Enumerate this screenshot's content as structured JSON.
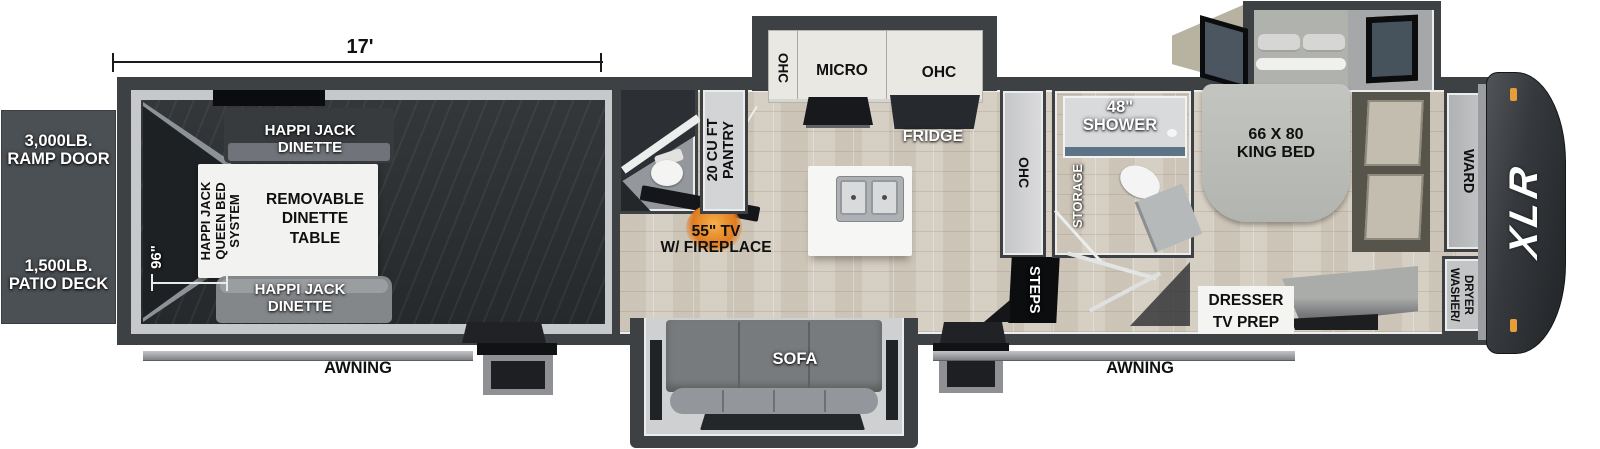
{
  "dimensions": {
    "length": "17'",
    "garage_width": "96\""
  },
  "exterior": {
    "ramp_door": "3,000LB.\nRAMP DOOR",
    "patio_deck": "1,500LB.\nPATIO DECK",
    "awning_left": "AWNING",
    "awning_right": "AWNING",
    "brand": "XLR"
  },
  "garage": {
    "dinette_top": "HAPPI JACK\nDINETTE",
    "dinette_bottom": "HAPPI JACK\nDINETTE",
    "queen_bed_system": "HAPPI JACK\nQUEEN BED\nSYSTEM",
    "removable_table": "REMOVABLE\nDINETTE\nTABLE"
  },
  "living": {
    "tv_fireplace": "55\" TV\nW/ FIREPLACE",
    "sofa": "SOFA",
    "steps": "STEPS"
  },
  "kitchen": {
    "ohc_left": "OHC",
    "micro": "MICRO",
    "ohc_right": "OHC",
    "fridge": "FRIDGE",
    "pantry": "20 CU FT\nPANTRY",
    "ohc_tall": "OHC"
  },
  "bathroom": {
    "shower": "48\"\nSHOWER",
    "storage": "STORAGE"
  },
  "bedroom": {
    "king_bed": "66 X 80\nKING BED",
    "wardrobe": "WARD",
    "dresser": "DRESSER\nTV PREP",
    "washer_dryer": "WASHER/\nDRYER\nPREP"
  },
  "colors": {
    "wall": "#3e4144",
    "floor_tile": "#d6cfc4",
    "garage_floor": "#2c2f32",
    "fireplace_glow": "#e07b20",
    "marker_light": "#e79d3a",
    "label_box": "#4b5054"
  }
}
